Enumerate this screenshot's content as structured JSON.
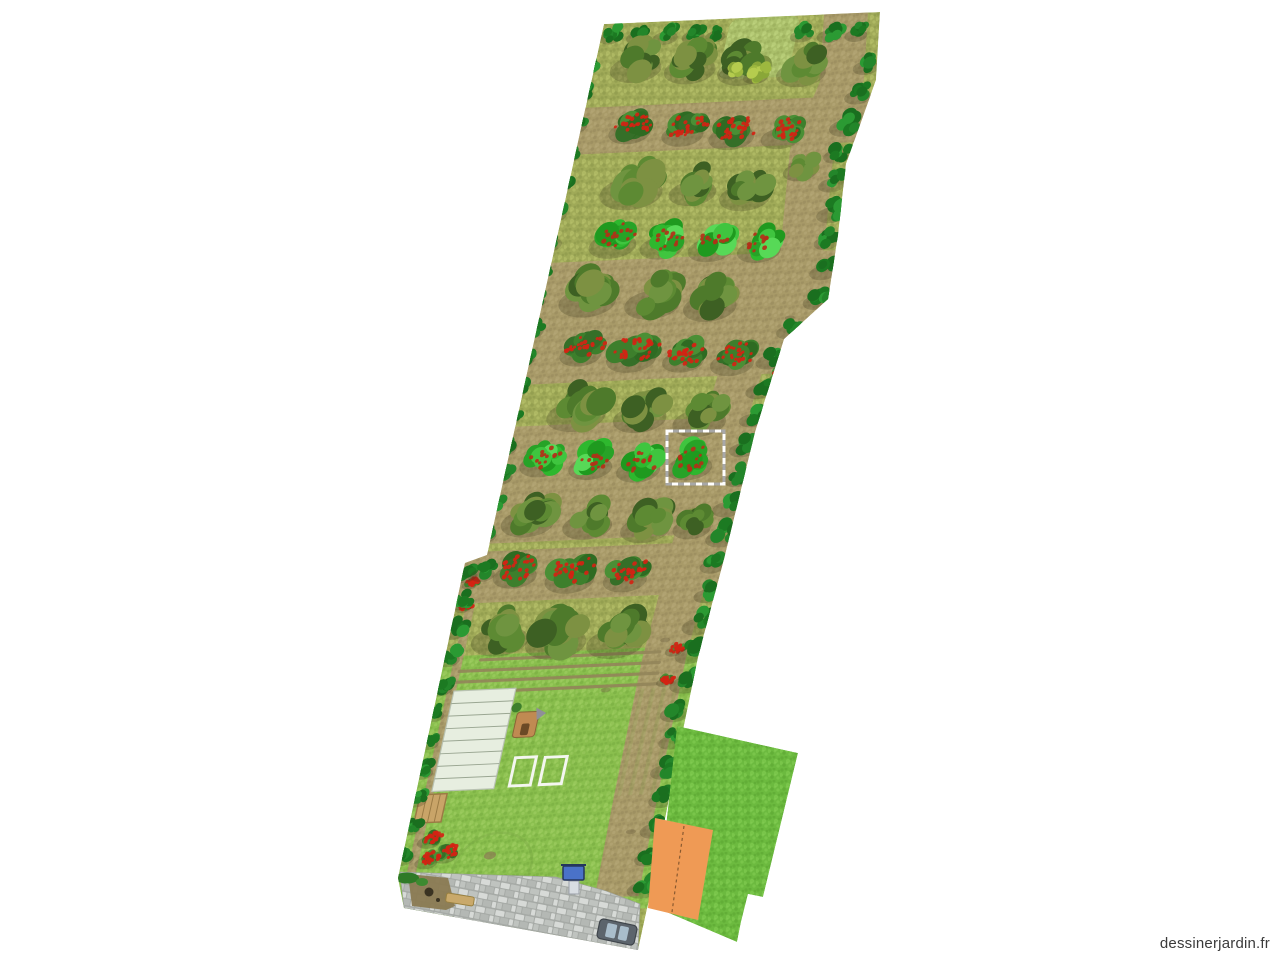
{
  "watermark": {
    "text": "dessinerjardin.fr"
  },
  "canvas": {
    "width": 1280,
    "height": 960,
    "background": "#ffffff"
  },
  "colors": {
    "soil": "#a89a68",
    "soil_dark": "#93855a",
    "soil_speck": "#b8aa7a",
    "grass": "#a0aa58",
    "grass_light": "#bcc66e",
    "grass_dark": "#879347",
    "lawn": "#8abf4e",
    "lawn_light": "#a3d266",
    "lawn_dark": "#74a93e",
    "lawn2": "#6cba3f",
    "lawn2_light": "#85cf55",
    "lawn2_dark": "#58a230",
    "hedge": "#aabf6a",
    "hedge_light": "#c4d983",
    "hedge_dark": "#93a855",
    "gravel_grout": "#a6aaa6",
    "stone1": "#bfc3bf",
    "stone2": "#d7dad7",
    "stone3": "#b4b8b4",
    "tree_palette": [
      "#3d6023",
      "#4e7a2b",
      "#5d8a33",
      "#6f9440",
      "#7d9142"
    ],
    "apple_palette": [
      "#27a327",
      "#3fc53f",
      "#2eb82e",
      "#57d957",
      "#1f9a1f"
    ],
    "berry_palette": [
      "#2e6b22",
      "#3d7f2c",
      "#4a8f35",
      "#356f28"
    ],
    "border_palette": [
      "#1c7a22",
      "#2b9a33",
      "#23862a",
      "#1a6f1f"
    ],
    "yellow_palette": [
      "#9db83f",
      "#b5cc4e",
      "#8aa738"
    ],
    "berry_red": "#d42314",
    "apple_red": "#b33018",
    "shadow": "#3f3a1f",
    "greenhouse_fill": "#e7eee0",
    "greenhouse_line": "#9aa692",
    "greenhouse_stroke": "#b9c2b2",
    "bed_stroke": "#f4f6f0",
    "hut_fill": "#c08a52",
    "hut_dark": "#6b4a26",
    "hut_roof": "#8f8f98",
    "crate_fill": "#c9a468",
    "crate_line": "#9a7a44",
    "pump_blue": "#4a72c8",
    "pump_dark": "#24365e",
    "pump_base": "#d8dde2",
    "car_body": "#5c646c",
    "car_stroke": "#3f454b",
    "car_window": "#a9bdcb",
    "bench": "#c9a96b",
    "bench_stroke": "#99803f",
    "dirt": "#8a7a52",
    "hole": "#3a3322",
    "building": "#ef9a55",
    "ridge": "#8a5a30",
    "selection": "#ffffff",
    "selection_under": "#a8a8a8",
    "watermark_text": "#3b3b3b",
    "path_spot": "#6b5e3f",
    "circle_stroke": "#7aa845",
    "gravel_bush": "#2f7a27",
    "gravel_bush2": "#3d8a30"
  },
  "plot": {
    "transform": [
      1,
      -0.045,
      -0.215,
      0.975,
      604,
      24
    ],
    "outline": [
      [
        604,
        24
      ],
      [
        880,
        12
      ],
      [
        876,
        80
      ],
      [
        846,
        164
      ],
      [
        838,
        235
      ],
      [
        828,
        299
      ],
      [
        784,
        339
      ],
      [
        755,
        432
      ],
      [
        724,
        559
      ],
      [
        698,
        657
      ],
      [
        670,
        793
      ],
      [
        650,
        895
      ],
      [
        638,
        950
      ],
      [
        404,
        908
      ],
      [
        398,
        878
      ],
      [
        465,
        563
      ],
      [
        487,
        555
      ]
    ],
    "right_edge": [
      [
        0,
        276
      ],
      [
        70,
        287
      ],
      [
        140,
        272
      ],
      [
        230,
        283
      ],
      [
        295,
        287
      ],
      [
        335,
        252
      ],
      [
        430,
        244
      ],
      [
        560,
        240
      ],
      [
        660,
        236
      ],
      [
        800,
        238
      ],
      [
        905,
        241
      ]
    ],
    "path_outer_inset": 12,
    "path_inner_inset": 56,
    "soil_bands": [
      [
        86,
        134
      ],
      [
        245,
        370
      ],
      [
        413,
        533
      ],
      [
        541,
        594
      ]
    ],
    "lawn": {
      "v1": 648,
      "v2": 918
    },
    "left_path": {
      "u": -10,
      "w": 9,
      "v1": 556,
      "v2": 875
    },
    "furrows": [
      [
        17,
        196,
        653
      ],
      [
        -2,
        198,
        664
      ],
      [
        -4,
        199,
        675
      ],
      [
        -5,
        200,
        686
      ]
    ],
    "stripes": {
      "u1": 66,
      "u2": 232,
      "v1": 690,
      "v2": 800,
      "step": 11
    },
    "hedge_patch": {
      "u": 127,
      "v": 0,
      "w": 70,
      "h": 63
    },
    "path_spots": [
      [
        253,
        313
      ],
      [
        196,
        452
      ],
      [
        199,
        641
      ],
      [
        207,
        838
      ],
      [
        222,
        155
      ],
      [
        150,
        690
      ]
    ]
  },
  "rows": [
    {
      "type": "border",
      "items": [
        [
          12,
          10,
          12
        ],
        [
          40,
          11,
          12
        ],
        [
          68,
          12,
          13
        ],
        [
          96,
          13,
          12
        ],
        [
          118,
          14,
          11
        ],
        [
          205,
          17,
          12
        ],
        [
          233,
          18,
          13
        ],
        [
          260,
          19,
          12
        ]
      ]
    },
    {
      "type": "trees",
      "items": [
        [
          45,
          37,
          27
        ],
        [
          100,
          41,
          27
        ],
        [
          154,
          45,
          27
        ],
        [
          213,
          50,
          26
        ]
      ]
    },
    {
      "type": "berries",
      "items": [
        [
          53,
          105,
          22
        ],
        [
          107,
          110,
          22
        ],
        [
          157,
          114,
          24
        ],
        [
          207,
          118,
          21
        ]
      ]
    },
    {
      "type": "trees",
      "items": [
        [
          68,
          163,
          33
        ],
        [
          130,
          169,
          25
        ],
        [
          184,
          175,
          27
        ],
        [
          234,
          155,
          18
        ]
      ]
    },
    {
      "type": "apples",
      "items": [
        [
          61,
          220,
          25
        ],
        [
          111,
          225,
          23
        ],
        [
          161,
          229,
          24
        ],
        [
          210,
          233,
          23
        ]
      ]
    },
    {
      "type": "trees",
      "items": [
        [
          48,
          275,
          30
        ],
        [
          114,
          281,
          29
        ],
        [
          173,
          287,
          28
        ]
      ]
    },
    {
      "type": "berries",
      "items": [
        [
          53,
          333,
          22
        ],
        [
          105,
          338,
          26
        ],
        [
          158,
          344,
          22
        ],
        [
          208,
          349,
          23
        ]
      ]
    },
    {
      "type": "trees",
      "items": [
        [
          62,
          392,
          31
        ],
        [
          127,
          399,
          28
        ],
        [
          188,
          406,
          28
        ]
      ]
    },
    {
      "type": "apples",
      "items": [
        [
          38,
          445,
          23
        ],
        [
          88,
          450,
          23
        ],
        [
          137,
          455,
          23
        ],
        [
          188,
          454,
          24
        ]
      ],
      "selected_index": 3
    },
    {
      "type": "trees",
      "items": [
        [
          37,
          502,
          28
        ],
        [
          98,
          509,
          26
        ],
        [
          157,
          515,
          26
        ],
        [
          204,
          519,
          20
        ]
      ]
    },
    {
      "type": "berries",
      "items": [
        [
          36,
          559,
          23
        ],
        [
          92,
          564,
          26
        ],
        [
          148,
          568,
          23
        ]
      ]
    },
    {
      "type": "trees",
      "items": [
        [
          35,
          622,
          30
        ],
        [
          92,
          626,
          32
        ],
        [
          152,
          630,
          30
        ]
      ]
    },
    {
      "type": "yellow",
      "items": [
        [
          142,
          52,
          12
        ],
        [
          168,
          57,
          13
        ]
      ]
    },
    {
      "type": "berries",
      "items": [
        [
          259,
          372,
          13
        ],
        [
          213,
          650,
          9
        ],
        [
          210,
          682,
          8
        ],
        [
          -8,
          572,
          8
        ],
        [
          -10,
          596,
          8
        ]
      ]
    }
  ],
  "borders": {
    "left_upper": {
      "u": -4,
      "v1": 40,
      "v2": 540,
      "step": 30,
      "r": 11
    },
    "left_lower": {
      "u": -15,
      "v1": 560,
      "v2": 866,
      "step": 29,
      "r": 10
    },
    "right": {
      "du": -6,
      "v1": 52,
      "v2": 896,
      "step": 30,
      "r": 13
    },
    "extras": [
      [
        3,
        560,
        13
      ]
    ]
  },
  "features": {
    "greenhouse": {
      "u": -3,
      "v": 684,
      "w": 62,
      "h": 103,
      "segments": 8
    },
    "beds": [
      {
        "u": 74,
        "v": 756,
        "w": 21,
        "h": 29
      },
      {
        "u": 104,
        "v": 757,
        "w": 22,
        "h": 28
      }
    ],
    "hut": {
      "u": 66,
      "v": 709,
      "w": 22,
      "h": 26
    },
    "crate": {
      "u": -14,
      "v": 790,
      "w": 27,
      "h": 29
    },
    "lawn_bushes": [
      [
        8,
        835,
        12
      ],
      [
        27,
        850,
        13
      ],
      [
        10,
        856,
        12
      ]
    ],
    "tree_circle": {
      "u": 75,
      "v": 869,
      "rx": 39,
      "ry": 36
    },
    "gravel": [
      [
        400,
        872
      ],
      [
        556,
        877
      ],
      [
        606,
        891
      ],
      [
        640,
        904
      ],
      [
        638,
        950
      ],
      [
        404,
        908
      ]
    ],
    "dirt_patch": [
      [
        408,
        874
      ],
      [
        448,
        878
      ],
      [
        455,
        906
      ],
      [
        446,
        910
      ],
      [
        412,
        906
      ]
    ],
    "holes": [
      [
        429,
        892,
        4.5
      ],
      [
        438,
        900,
        2
      ]
    ],
    "gravel_bushes": [
      [
        407,
        878,
        12,
        5.5
      ],
      [
        422,
        882,
        6,
        4
      ]
    ],
    "bench": {
      "x": 446,
      "y": 895,
      "w": 28,
      "h": 9,
      "rot": 9
    },
    "pump": {
      "x": 563,
      "y": 866
    },
    "car": {
      "x": 598,
      "y": 922,
      "w": 38,
      "h": 20,
      "rot": 12
    }
  },
  "secondary_plot": {
    "outline": [
      [
        677,
        726
      ],
      [
        798,
        753
      ],
      [
        763,
        897
      ],
      [
        748,
        894
      ],
      [
        741,
        922
      ],
      [
        737,
        942
      ],
      [
        657,
        908
      ]
    ],
    "building": [
      [
        655,
        818
      ],
      [
        713,
        830
      ],
      [
        698,
        920
      ],
      [
        648,
        908
      ]
    ],
    "ridge": [
      [
        684,
        826
      ],
      [
        672,
        912
      ]
    ]
  },
  "selection": {
    "x": 667,
    "y": 431,
    "width": 57,
    "height": 53
  }
}
